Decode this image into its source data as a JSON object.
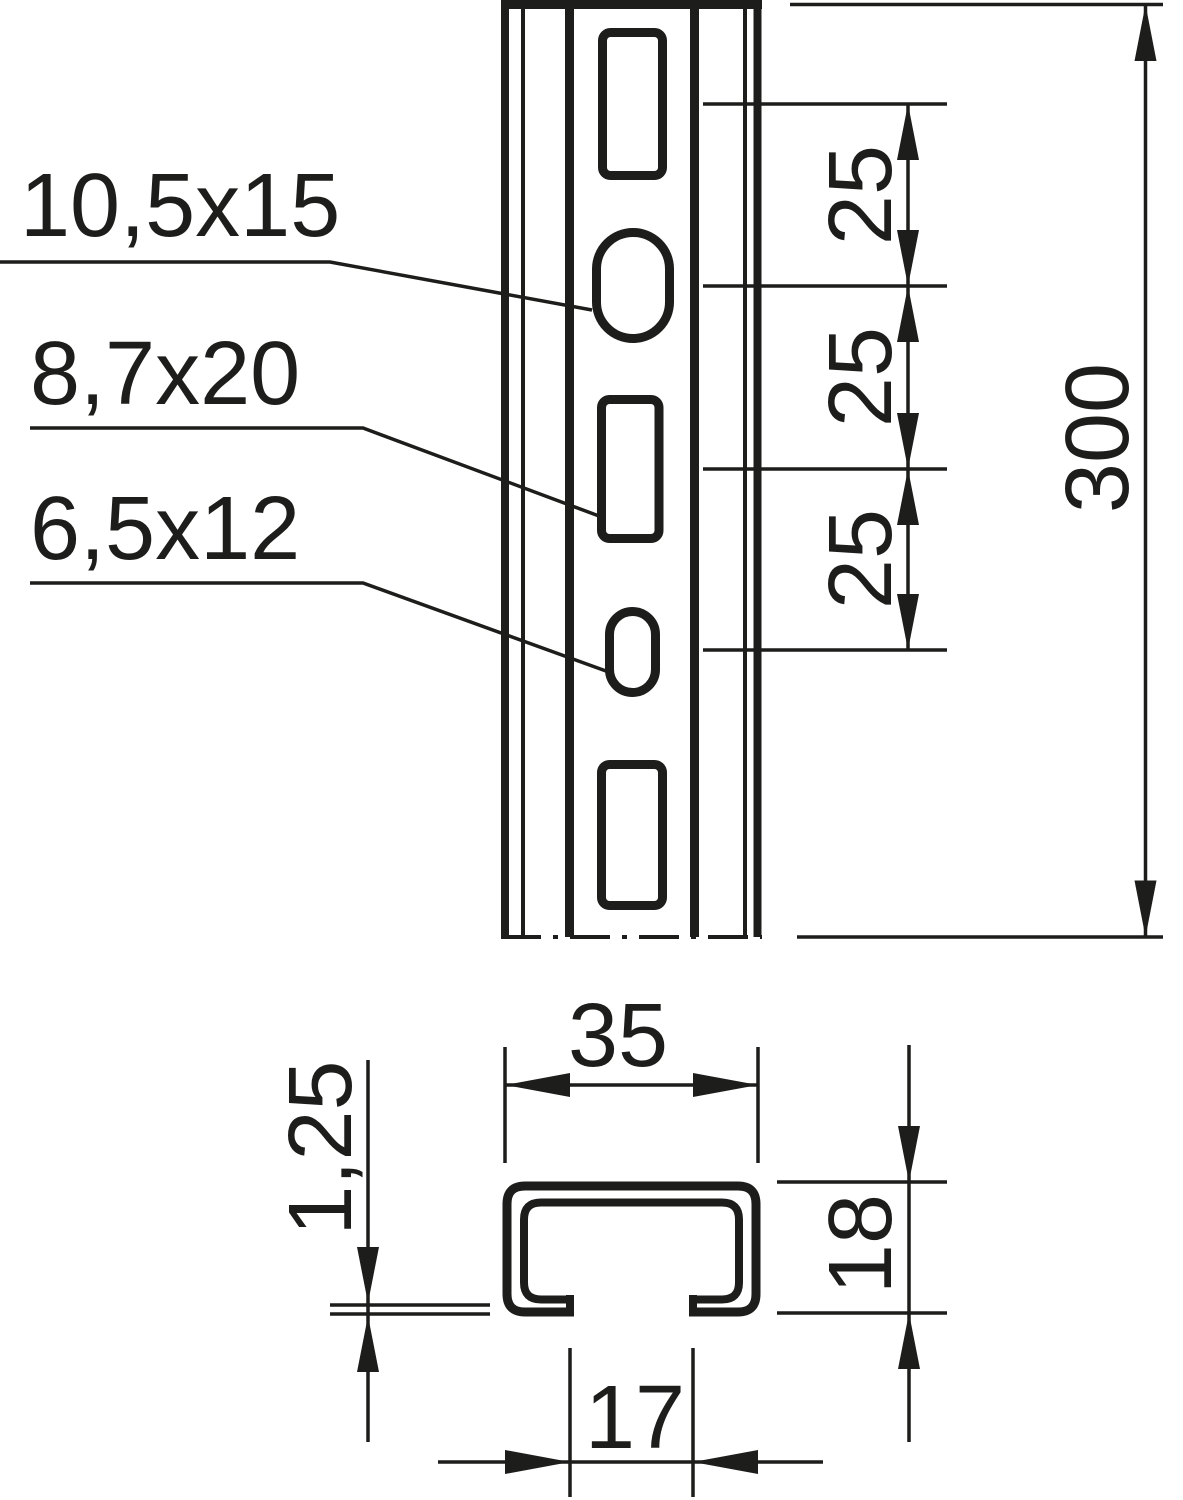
{
  "front_view": {
    "slot_size_labels": [
      "10,5x15",
      "8,7x20",
      "6,5x12"
    ],
    "slot_pitch_labels": [
      "25",
      "25",
      "25"
    ],
    "length_label": "300"
  },
  "section_view": {
    "outer_width_label": "35",
    "material_thickness_label": "1,25",
    "height_label": "18",
    "slot_opening_label": "17"
  },
  "colors": {
    "ink": "#1d1d1b",
    "background": "#ffffff"
  }
}
